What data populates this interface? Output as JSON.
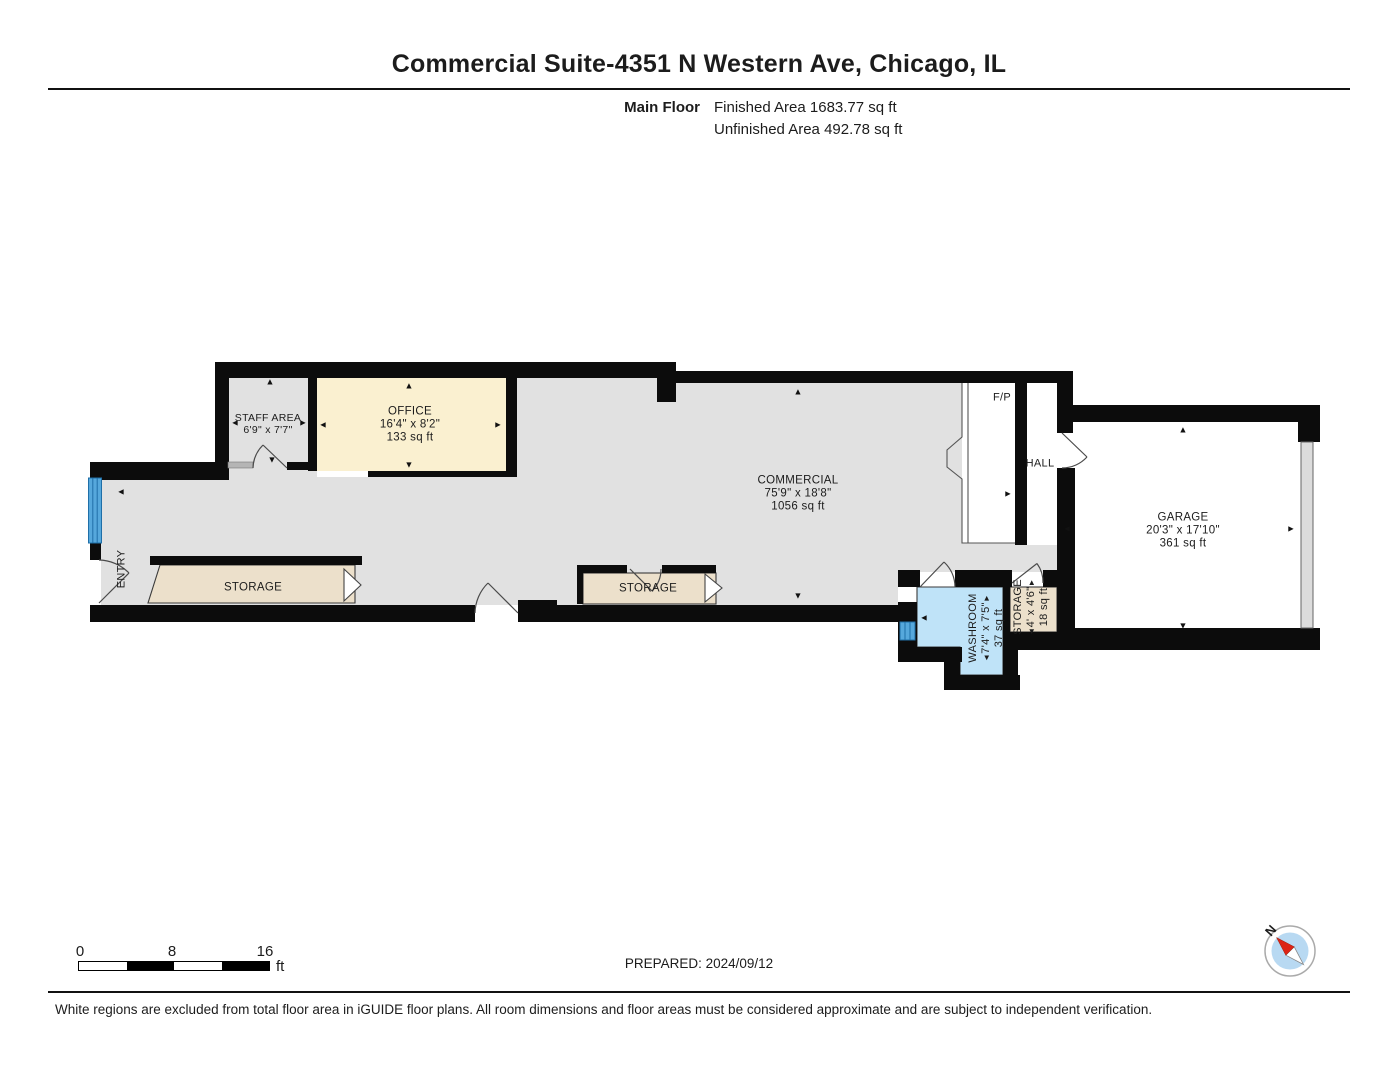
{
  "header": {
    "title": "Commercial Suite-4351 N Western Ave, Chicago, IL",
    "floor_label": "Main Floor",
    "finished_area": "Finished Area 1683.77 sq ft",
    "unfinished_area": "Unfinished Area 492.78 sq ft"
  },
  "rooms": {
    "staff_area": {
      "name": "STAFF AREA",
      "dims": "6'9\" x 7'7\""
    },
    "office": {
      "name": "OFFICE",
      "dims": "16'4\" x 8'2\"",
      "area": "133 sq ft"
    },
    "commercial": {
      "name": "COMMERCIAL",
      "dims": "75'9\" x 18'8\"",
      "area": "1056 sq ft"
    },
    "garage": {
      "name": "GARAGE",
      "dims": "20'3\" x 17'10\"",
      "area": "361 sq ft"
    },
    "storage_left": {
      "name": "STORAGE"
    },
    "storage_mid": {
      "name": "STORAGE"
    },
    "storage_small": {
      "name": "STORAGE",
      "dims": "4' x 4'6\"",
      "area": "18 sq ft"
    },
    "washroom": {
      "name": "WASHROOM",
      "dims": "7'4\" x 7'5\"",
      "area": "37 sq ft"
    },
    "hall": {
      "name": "HALL"
    },
    "fireplace": {
      "name": "F/P"
    },
    "entry": {
      "name": "ENTRY"
    }
  },
  "scale_bar": {
    "start": "0",
    "mid": "8",
    "end": "16",
    "unit": "ft"
  },
  "footer": {
    "prepared": "PREPARED: 2024/09/12",
    "compass_north": "N",
    "disclaimer": "White regions are excluded from total floor area in iGUIDE floor plans. All room dimensions and floor areas must be considered approximate and are subject to independent verification."
  },
  "icons": {
    "up": "▲",
    "down": "▼",
    "left": "◄",
    "right": "►"
  },
  "colors": {
    "wall": "#0c0c0c",
    "floor-gray": "#e1e1e1",
    "office-cream": "#faf0d0",
    "storage-beige": "#ece0cb",
    "washroom-blue": "#bfe3f8",
    "window-blue": "#56a8dc",
    "window-line": "#1f6fa8",
    "threshold-gray": "#b5b5b5",
    "garage-door-gray": "#dcdcdc",
    "compass-blue": "#b8d9f2",
    "compass-red": "#dd2314"
  }
}
